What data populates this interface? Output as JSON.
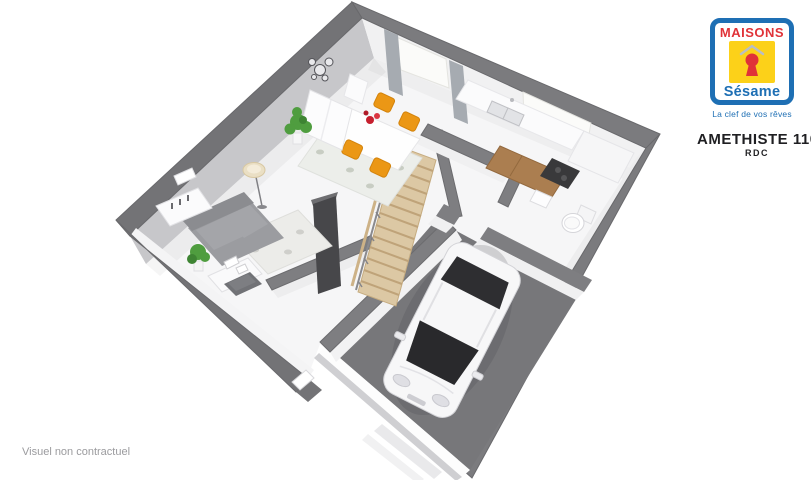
{
  "logo": {
    "maisons": "MAISONS",
    "sesame": "Sésame",
    "tagline": "La clef de vos rêves",
    "colors": {
      "blue": "#1e6fb4",
      "yellow": "#fcd119",
      "red": "#e03238"
    }
  },
  "plan": {
    "title": "AMETHISTE 110GI",
    "floor_label": "RDC",
    "disclaimer": "Visuel non contractuel"
  },
  "palette": {
    "wall_gray": "#7b7b7e",
    "wall_face_gray": "#c7c7ca",
    "floor": "#f6f6f7",
    "garage_floor": "#77777a",
    "stairs_wood": "#dcc8a4",
    "cabinet_wood": "#ab7e50",
    "chair_orange": "#eb9715",
    "plant_green": "#4f9d3f",
    "flower_red": "#c61f2e",
    "curtain_gray": "#a6abb1",
    "car_body": "#f7f7f8",
    "car_glass": "#2e2e31",
    "text_dark": "#1f1f22",
    "text_gray": "#9b9b9e"
  }
}
